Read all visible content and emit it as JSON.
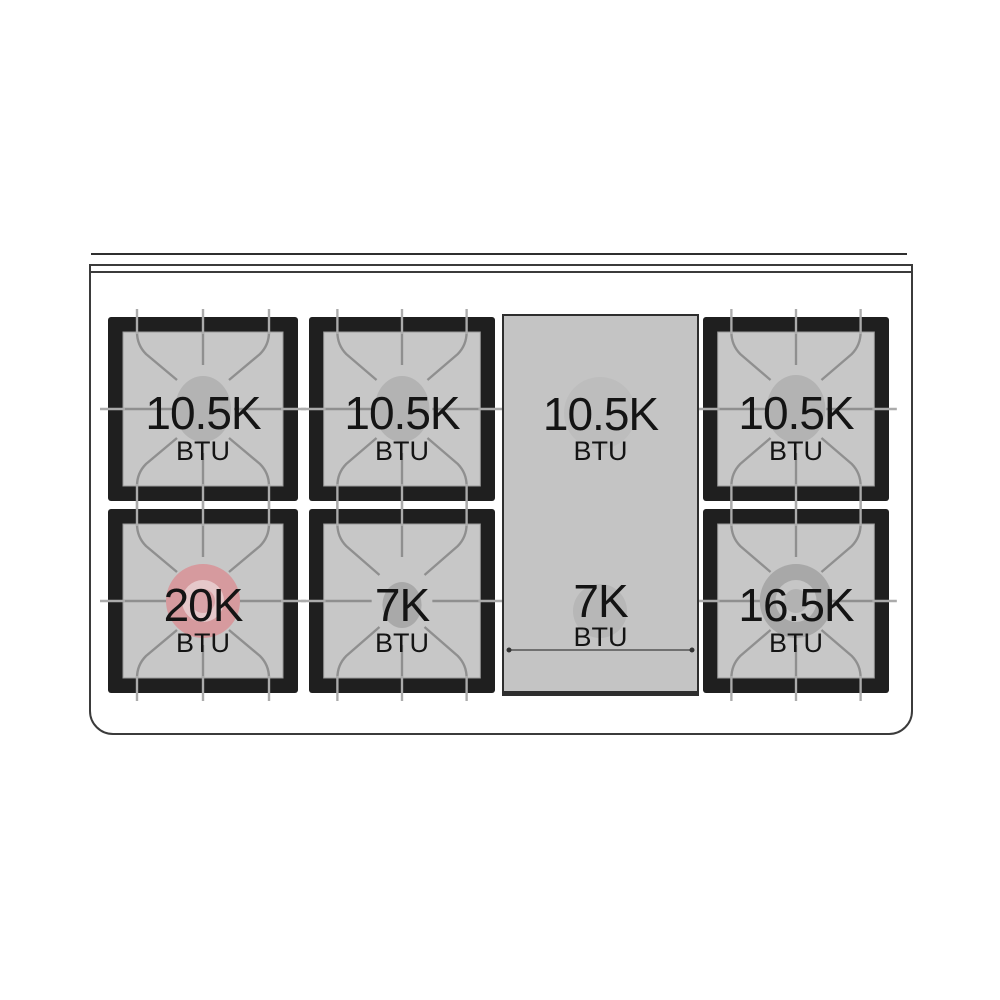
{
  "diagram": {
    "title": "range-cooktop-burner-layout",
    "rows": 2,
    "columns": 4,
    "burner_count": 6,
    "griddle_present": true
  },
  "burners": [
    {
      "id": "top-left",
      "value": "10.5K",
      "unit": "BTU",
      "style": "standard-burner"
    },
    {
      "id": "top-mid-left",
      "value": "10.5K",
      "unit": "BTU",
      "style": "standard-burner"
    },
    {
      "id": "top-right",
      "value": "10.5K",
      "unit": "BTU",
      "style": "standard-burner"
    },
    {
      "id": "bottom-left",
      "value": "20K",
      "unit": "BTU",
      "style": "dual-ring-red-burner"
    },
    {
      "id": "bottom-mid-left",
      "value": "7K",
      "unit": "BTU",
      "style": "small-burner"
    },
    {
      "id": "bottom-right",
      "value": "16.5K",
      "unit": "BTU",
      "style": "dual-ring-gray-burner"
    }
  ],
  "griddle": {
    "top": {
      "value": "10.5K",
      "unit": "BTU"
    },
    "bottom": {
      "value": "7K",
      "unit": "BTU"
    }
  },
  "colors": {
    "background": "#ffffff",
    "outline": "#3b3b3b",
    "grate_frame_black": "#1f1f1f",
    "grate_inner_gray": "#c7c7c7",
    "grate_line_gray": "#8f8f8f",
    "burner_oval_gray": "#b3b3b3",
    "griddle_gray": "#c4c4c4",
    "dual_ring_red": "#d69a9e",
    "dual_ring_red_inner": "#e6c8ca",
    "dual_ring_gray": "#a8a8a8",
    "dual_ring_gray_inner": "#c6c6c6",
    "label_text": "#141414"
  }
}
